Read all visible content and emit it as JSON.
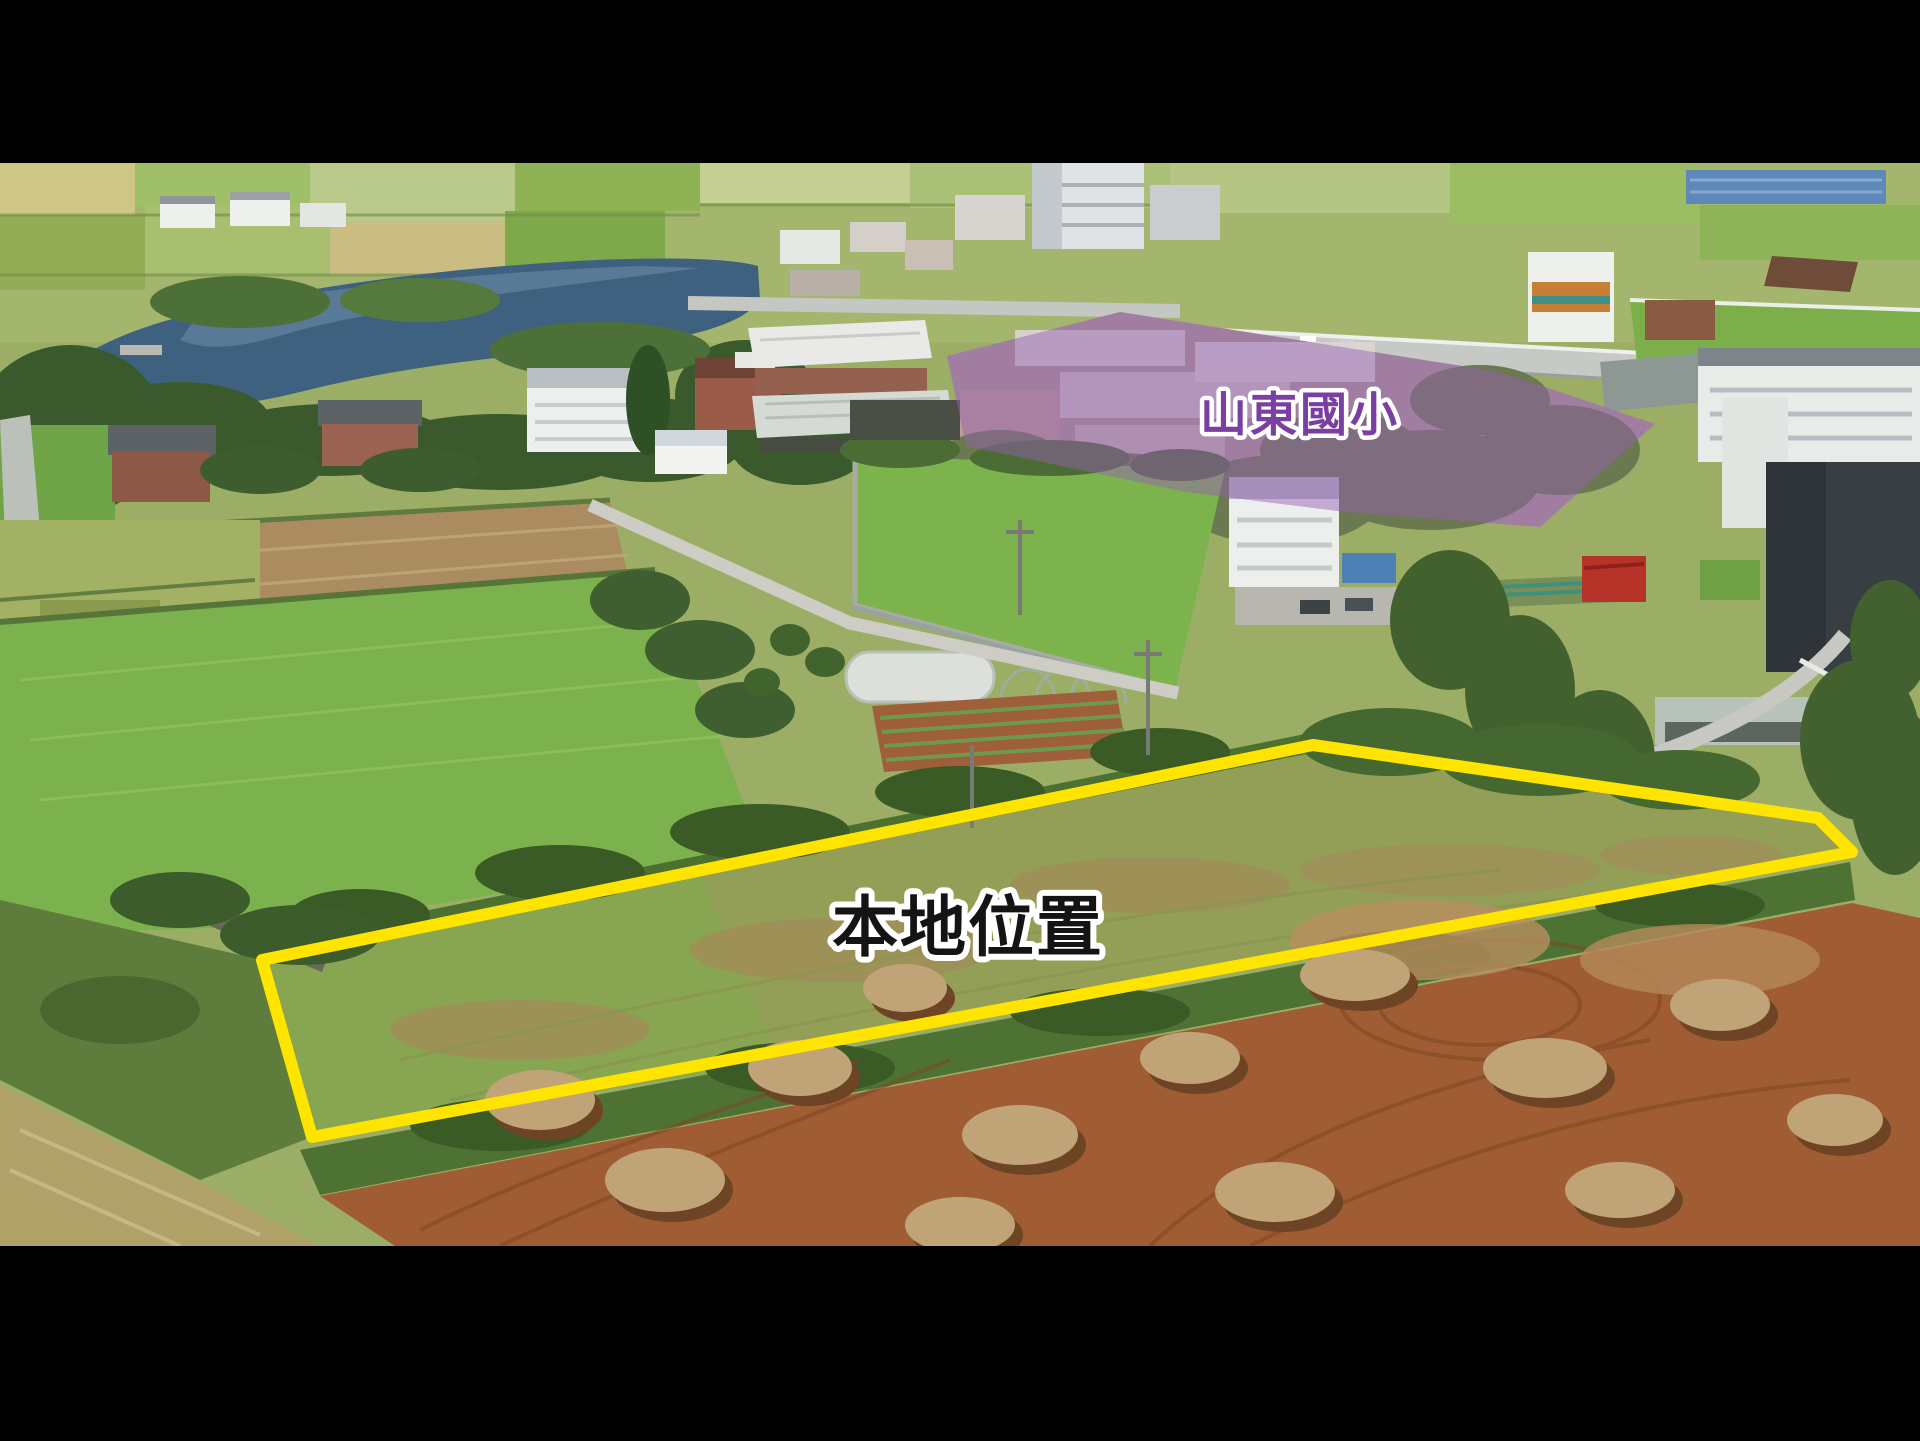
{
  "canvas": {
    "letterbox_color": "#000000",
    "photo_top": 163,
    "photo_height": 1083
  },
  "annotations": {
    "site_label": {
      "text": "本地位置",
      "color": "#141414",
      "outline": "#ffffff"
    },
    "school_label": {
      "text": "山東國小",
      "color": "#7b3fa3",
      "outline": "#ffffff"
    },
    "site_outline": {
      "points": "262,960 1313,745 1818,818 1852,852 312,1137",
      "stroke": "#ffe400",
      "stroke_width": "12"
    },
    "school_overlay": {
      "points": "947,356 1120,312 1500,372 1655,424 1540,527 1345,512 1186,492 966,446",
      "fill": "rgba(151,94,180,0.47)"
    }
  }
}
